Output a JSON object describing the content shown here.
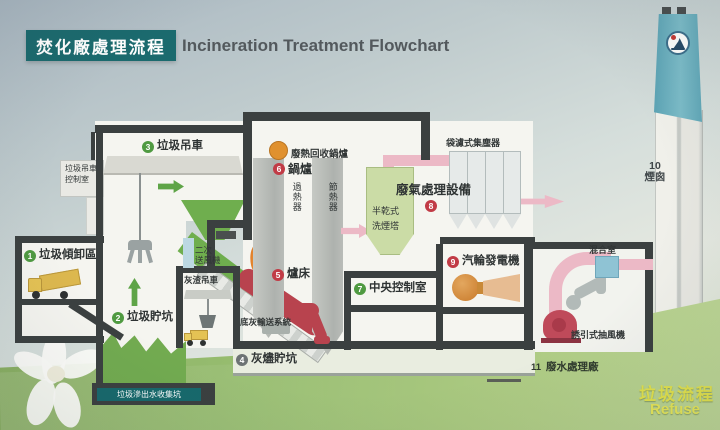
{
  "title": {
    "zh": "焚化廠處理流程",
    "en": "Incineration Treatment Flowchart"
  },
  "stations": {
    "s1": {
      "num": "1",
      "label": "垃圾傾卸區"
    },
    "s2": {
      "num": "2",
      "label": "垃圾貯坑"
    },
    "s3": {
      "num": "3",
      "label": "垃圾吊車"
    },
    "s4": {
      "num": "4",
      "label": "灰燼貯坑"
    },
    "s5": {
      "num": "5",
      "label": "爐床"
    },
    "s6": {
      "num": "6",
      "label": "鍋爐"
    },
    "s7": {
      "num": "7",
      "label": "中央控制室"
    },
    "s8": {
      "num": "8",
      "label": "廢氣處理設備"
    },
    "s9": {
      "num": "9",
      "label": "汽輪發電機"
    },
    "s10": {
      "num": "10",
      "label": "煙囪"
    },
    "s11": {
      "num": "11",
      "label": "廢水處理廠"
    }
  },
  "sublabels": {
    "crane_control_1": "垃圾吊車",
    "crane_control_2": "控制室",
    "boiler_recovery": "廢熱回收鍋爐",
    "superheater": "過熱器",
    "economizer": "節熱器",
    "secondary_fan_1": "二次",
    "secondary_fan_2": "送風機",
    "ash_crane": "灰渣吊車",
    "bottom_ash": "底灰輸送系統",
    "leachate_pit": "垃圾滲出水收集坑",
    "scrubber_1": "半乾式",
    "scrubber_2": "洗煙塔",
    "bag_filter": "袋濾式集塵器",
    "mixing_chamber": "混合室",
    "induced_fan": "誘引式抽風機"
  },
  "footer": {
    "flow_zh": "垃圾流程",
    "flow_en": "Refuse"
  },
  "colors": {
    "title_teal": "#1b6a6e",
    "wall": "#3b4040",
    "process_green": "#6fae4e",
    "flue_pink": "#ecb9c6",
    "equipment_red": "#bf4a5a",
    "grass_green": "#97bd70",
    "chimney_teal": "#6cb0bf",
    "footer_yellow": "#e2e24c",
    "num_green": "#4f9a41",
    "num_red": "#c13b46",
    "num_gray": "#6d7374"
  }
}
